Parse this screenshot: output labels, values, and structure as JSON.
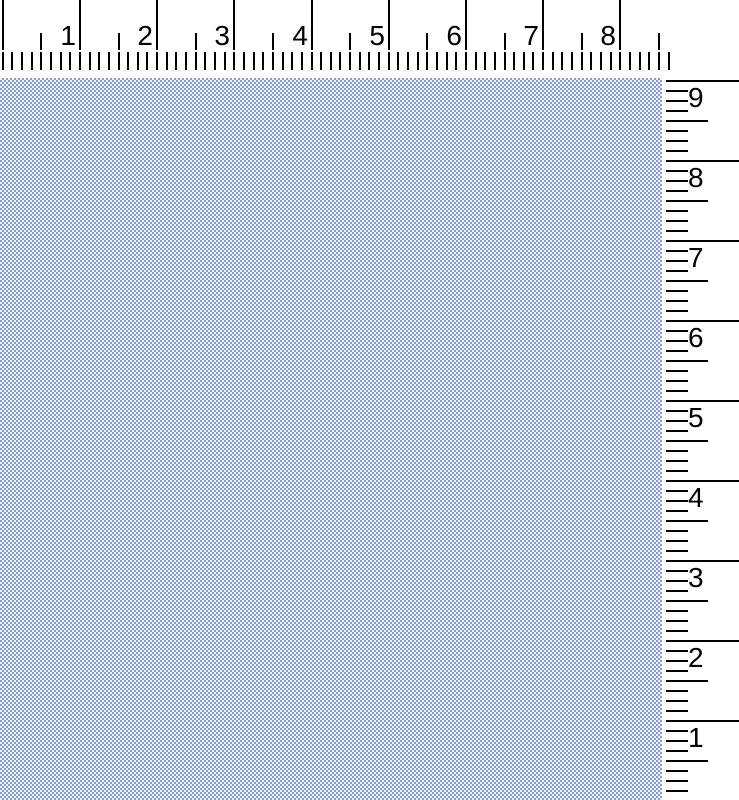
{
  "workspace": {
    "background": "#ffffff"
  },
  "pattern": {
    "description": "blue-white checkerboard fabric swatch",
    "colors": {
      "blue": "#809ad8",
      "light": "#f5f6fb"
    }
  },
  "rulers": {
    "ink_color": "#000000",
    "top": {
      "numbers": [
        "1",
        "2",
        "3",
        "4",
        "5",
        "6",
        "7",
        "8"
      ]
    },
    "right": {
      "numbers": [
        "9",
        "8",
        "7",
        "6",
        "5",
        "4",
        "3",
        "2",
        "1"
      ]
    }
  }
}
